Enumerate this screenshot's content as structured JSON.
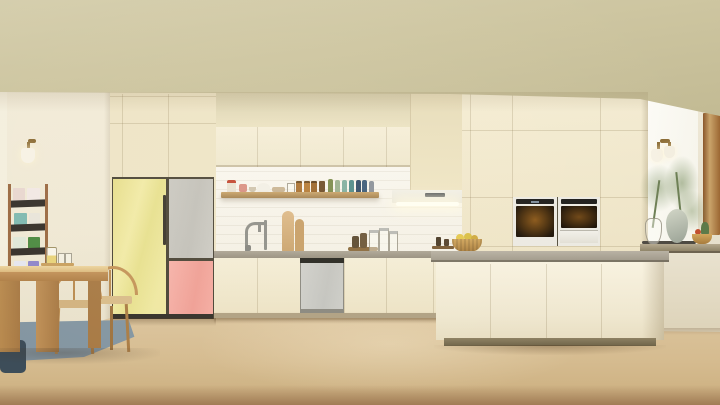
{
  "meta": {
    "title": "Kitchen showroom scene"
  },
  "scene": {
    "description": "Warm cream showroom kitchen with a pastel two-tone bespoke refrigerator (yellow, grey and pink glass panels), cream flat-front cabinetry, built-in double wall ovens, slim range hood, grey-top island with fruit basket, oak dining table with wishbone chairs, magazine rack, brass sconces and a bright window with green branches in vases"
  },
  "palette": {
    "ceiling": "#cdc5a0",
    "wall": "#f0e9d6",
    "cabinet": "#f3ecd5",
    "soffit": "#d8cfae",
    "backsplash": "#f8f5ed",
    "counter": "#a49d8e",
    "island-top": "#b2ab9d",
    "fridge-yellow": "#e9e294",
    "fridge-grey": "#c7c5be",
    "fridge-pink": "#f3aaa1",
    "dishwasher": "#cbcbc6",
    "hood": "#efede4",
    "oven-frame": "#eceae2",
    "oven-glass": "#231909",
    "shelf-wood": "#b28f5b",
    "table-wood": "#c99c5f",
    "chair-wood": "#c49459",
    "floor": "#d9c198",
    "rug": "#8496a2",
    "cushion": "#3d4d59",
    "window": "#fbfaf3",
    "frame-brown": "#8a572b",
    "plant-green": "#7d9264",
    "basket": "#c89a52",
    "rack-wood": "#9b6a42"
  },
  "objects": {
    "refrigerator": "Bespoke two-tone refrigerator with yellow, grey and pink glass panels",
    "wall_ovens": "Built-in double wall ovens",
    "range_hood": "Slim range hood with under-cabinet light",
    "dishwasher": "Built-in dishwasher with grey panel",
    "island": "Kitchen island with grey worktop",
    "dining_table": "Oak dining table with wishbone chairs",
    "magazine_rack": "Wall magazine rack with colorful covers",
    "sconce": "Brass wall sconce with glass shade",
    "window_plants": "Vases with green branches at bright window",
    "fruit_basket": "Woven basket with fruit",
    "floating_shelf": "Wood floating shelf with jars and ceramics",
    "sink_faucet": "Chrome gooseneck faucet",
    "cutting_boards": "Wooden cutting boards",
    "rug": "Blue-grey flatweave rug",
    "floor": "Light oak plank floor",
    "ceiling": "Khaki soffit ceiling",
    "window": "Bright side window"
  }
}
